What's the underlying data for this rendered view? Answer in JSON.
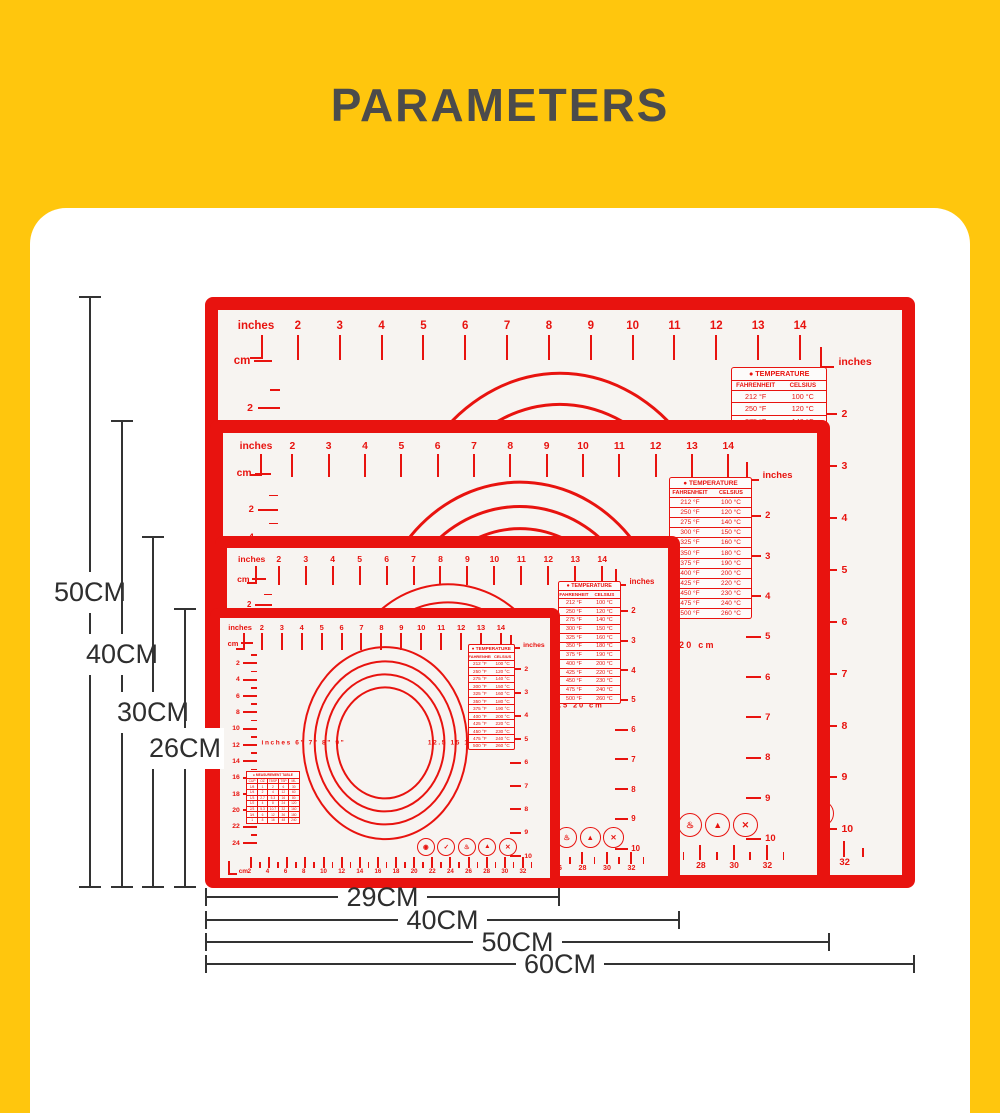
{
  "title": "PARAMETERS",
  "colors": {
    "background": "#FFC60D",
    "panel": "#FFFFFF",
    "mat_red": "#E8130F",
    "mat_surface": "#F7F4F1",
    "dimension_line": "#333333",
    "title_text": "#4B4B4B"
  },
  "dimensions": {
    "vertical": [
      {
        "label": "50CM"
      },
      {
        "label": "40CM"
      },
      {
        "label": "30CM"
      },
      {
        "label": "26CM"
      }
    ],
    "horizontal": [
      {
        "label": "29CM"
      },
      {
        "label": "40CM"
      },
      {
        "label": "50CM"
      },
      {
        "label": "60CM"
      }
    ]
  },
  "mats": [
    {
      "name": "baking-mat-60x50cm"
    },
    {
      "name": "baking-mat-50x40cm"
    },
    {
      "name": "baking-mat-40x30cm"
    },
    {
      "name": "baking-mat-29x26cm"
    }
  ],
  "mat_print": {
    "top_ruler_label": "inches",
    "top_ruler_numbers": [
      "2",
      "3",
      "4",
      "5",
      "6",
      "7",
      "8",
      "9",
      "10",
      "11",
      "12",
      "13",
      "14"
    ],
    "left_ruler_label": "cm",
    "left_ruler_numbers": [
      "2",
      "4",
      "6",
      "8",
      "10",
      "12",
      "14",
      "16",
      "18",
      "20",
      "22",
      "24"
    ],
    "right_ruler_label": "inches",
    "right_ruler_numbers": [
      "2",
      "3",
      "4",
      "5",
      "6",
      "7",
      "8",
      "9",
      "10"
    ],
    "bottom_ruler_label": "cm",
    "bottom_ruler_numbers": [
      "2",
      "4",
      "6",
      "8",
      "10",
      "12",
      "14",
      "16",
      "18",
      "20",
      "22",
      "24",
      "26",
      "28",
      "30",
      "32"
    ],
    "circles_left_label": "inches 6\" 7\" 8\" 9\"",
    "circles_right_label": "12.5 15 17.5 20 cm",
    "temperature_table": {
      "title": "● TEMPERATURE",
      "columns": [
        "FAHRENHEIT",
        "CELSIUS"
      ],
      "rows": [
        [
          "212 °F",
          "100 °C"
        ],
        [
          "250 °F",
          "120 °C"
        ],
        [
          "275 °F",
          "140 °C"
        ],
        [
          "300 °F",
          "150 °C"
        ],
        [
          "325 °F",
          "160 °C"
        ],
        [
          "350 °F",
          "180 °C"
        ],
        [
          "375 °F",
          "190 °C"
        ],
        [
          "400 °F",
          "200 °C"
        ],
        [
          "425 °F",
          "220 °C"
        ],
        [
          "450 °F",
          "230 °C"
        ],
        [
          "475 °F",
          "240 °C"
        ],
        [
          "500 °F",
          "260 °C"
        ]
      ]
    },
    "measurement_table": {
      "title": "● MEASUREMENT TABLE",
      "columns": [
        "CUP",
        "OZ",
        "TBSP",
        "TSP",
        "ML"
      ],
      "rows": [
        [
          "1/8",
          "1",
          "2",
          "6",
          "30"
        ],
        [
          "1/4",
          "2",
          "4",
          "12",
          "60"
        ],
        [
          "1/3",
          "2.7",
          "5.3",
          "16",
          "80"
        ],
        [
          "1/2",
          "4",
          "8",
          "24",
          "120"
        ],
        [
          "2/3",
          "5.3",
          "10.7",
          "32",
          "160"
        ],
        [
          "3/4",
          "6",
          "12",
          "36",
          "180"
        ],
        [
          "1",
          "8",
          "16",
          "48",
          "240"
        ]
      ]
    },
    "icons": [
      {
        "name": "lfgb-badge-icon",
        "glyph": "◉"
      },
      {
        "name": "food-grade-check-icon",
        "glyph": "✓"
      },
      {
        "name": "oven-safe-icon",
        "glyph": "♨"
      },
      {
        "name": "heat-resistant-flame-icon",
        "glyph": "▲"
      },
      {
        "name": "no-knife-icon",
        "glyph": "✕"
      }
    ]
  }
}
